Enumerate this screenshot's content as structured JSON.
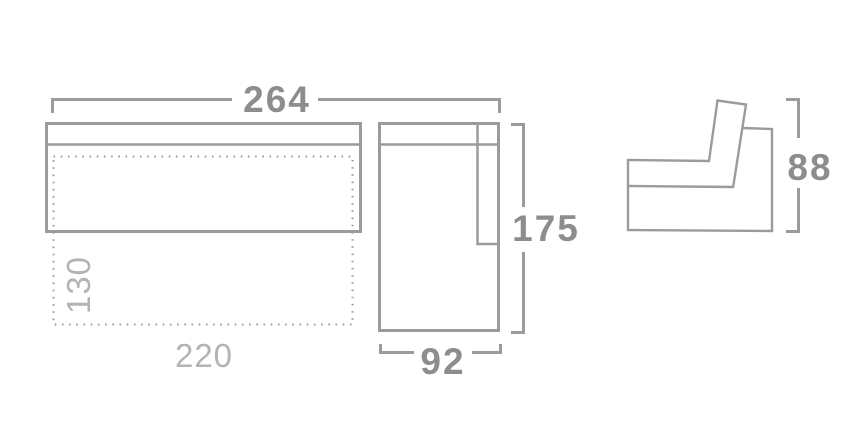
{
  "diagram": {
    "kind": "sofa-dimension-drawing",
    "views": [
      "top-view-sofa",
      "top-view-chaise",
      "side-profile"
    ]
  },
  "colors": {
    "background": "#ffffff",
    "line": "#9b9b9b",
    "dimension_text": "#8d8d8d",
    "secondary_text": "#b3b3b3"
  },
  "dimensions": {
    "overall_width": "264",
    "chaise_depth": "175",
    "chaise_width": "92",
    "seat_height": "88",
    "bed_depth": "130",
    "bed_length": "220"
  }
}
